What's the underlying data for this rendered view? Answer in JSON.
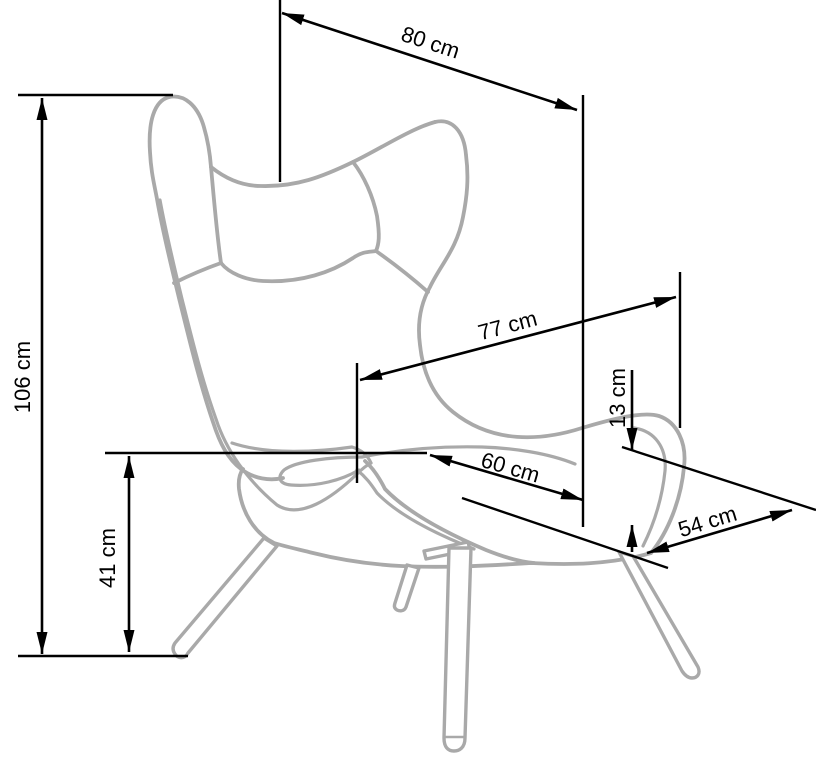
{
  "diagram": {
    "subject": "Wingback armchair technical line drawing with dimensions",
    "unit": "cm",
    "colors": {
      "background": "#ffffff",
      "dimension_lines": "#000000",
      "chair_artwork": "#a9a9a9"
    },
    "measurements": [
      {
        "name": "overall-width",
        "label": "80 cm",
        "value": 80
      },
      {
        "name": "overall-height",
        "label": "106 cm",
        "value": 106
      },
      {
        "name": "overall-depth",
        "label": "77 cm",
        "value": 77
      },
      {
        "name": "seat-cushion-thickness",
        "label": "13 cm",
        "value": 13
      },
      {
        "name": "seat-width",
        "label": "60 cm",
        "value": 60
      },
      {
        "name": "seat-height",
        "label": "41 cm",
        "value": 41
      },
      {
        "name": "seat-depth",
        "label": "54 cm",
        "value": 54
      }
    ]
  }
}
